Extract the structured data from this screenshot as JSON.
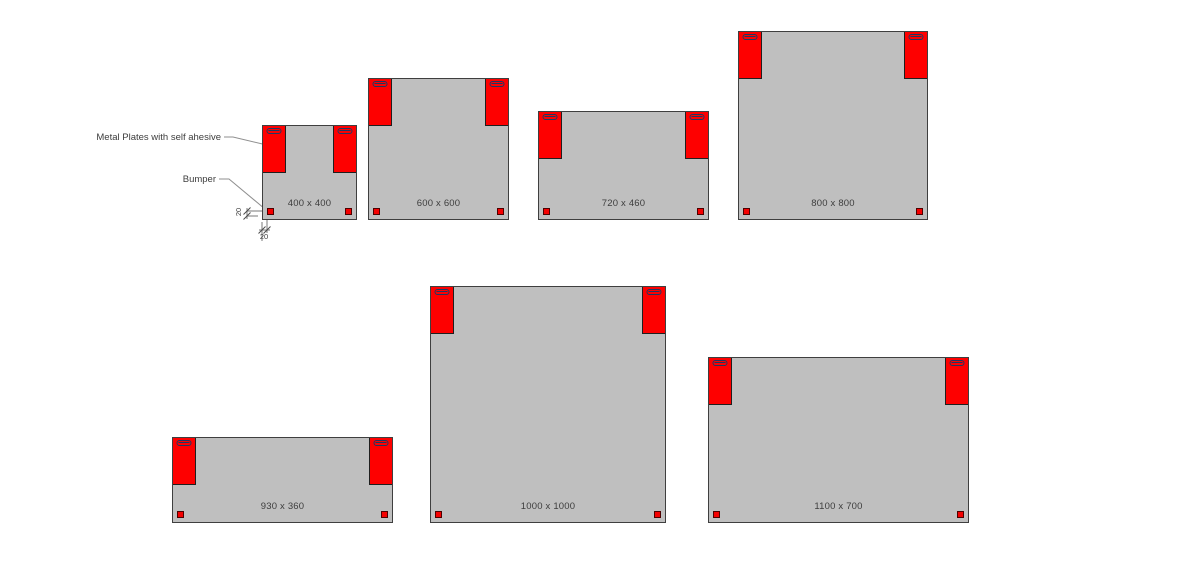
{
  "figure": {
    "annotations": {
      "metal_plates_label": "Metal Plates with self ahesive",
      "bumper_label": "Bumper",
      "dim_vertical_value": "20",
      "dim_horizontal_value": "20"
    },
    "colors": {
      "background": "#ffffff",
      "panel_fill": "#bfbfbf",
      "panel_border": "#3f3f3f",
      "plate_fill": "#fe0000",
      "plate_border": "#1f1f1f",
      "slot_outline": "#1f3864",
      "bumper_fill": "#f40000",
      "bumper_border": "#4d0000",
      "text": "#3d3d3d",
      "leader_line": "#8f8f8f"
    },
    "panels": [
      {
        "id": "400x400",
        "label": "400 x 400",
        "x": 262,
        "y": 125,
        "w": 95,
        "h": 95
      },
      {
        "id": "600x600",
        "label": "600 x 600",
        "x": 368,
        "y": 78,
        "w": 141,
        "h": 142
      },
      {
        "id": "720x460",
        "label": "720 x 460",
        "x": 538,
        "y": 111,
        "w": 171,
        "h": 109
      },
      {
        "id": "800x800",
        "label": "800 x 800",
        "x": 738,
        "y": 31,
        "w": 190,
        "h": 189
      },
      {
        "id": "930x360",
        "label": "930 x 360",
        "x": 172,
        "y": 437,
        "w": 221,
        "h": 86
      },
      {
        "id": "1000x1000",
        "label": "1000 x 1000",
        "x": 430,
        "y": 286,
        "w": 236,
        "h": 237
      },
      {
        "id": "1100x700",
        "label": "1100 x 700",
        "x": 708,
        "y": 357,
        "w": 261,
        "h": 166
      }
    ],
    "plate_size": {
      "w": 23,
      "h": 47
    },
    "bumper_size": {
      "size": 7,
      "inset": 4
    }
  }
}
